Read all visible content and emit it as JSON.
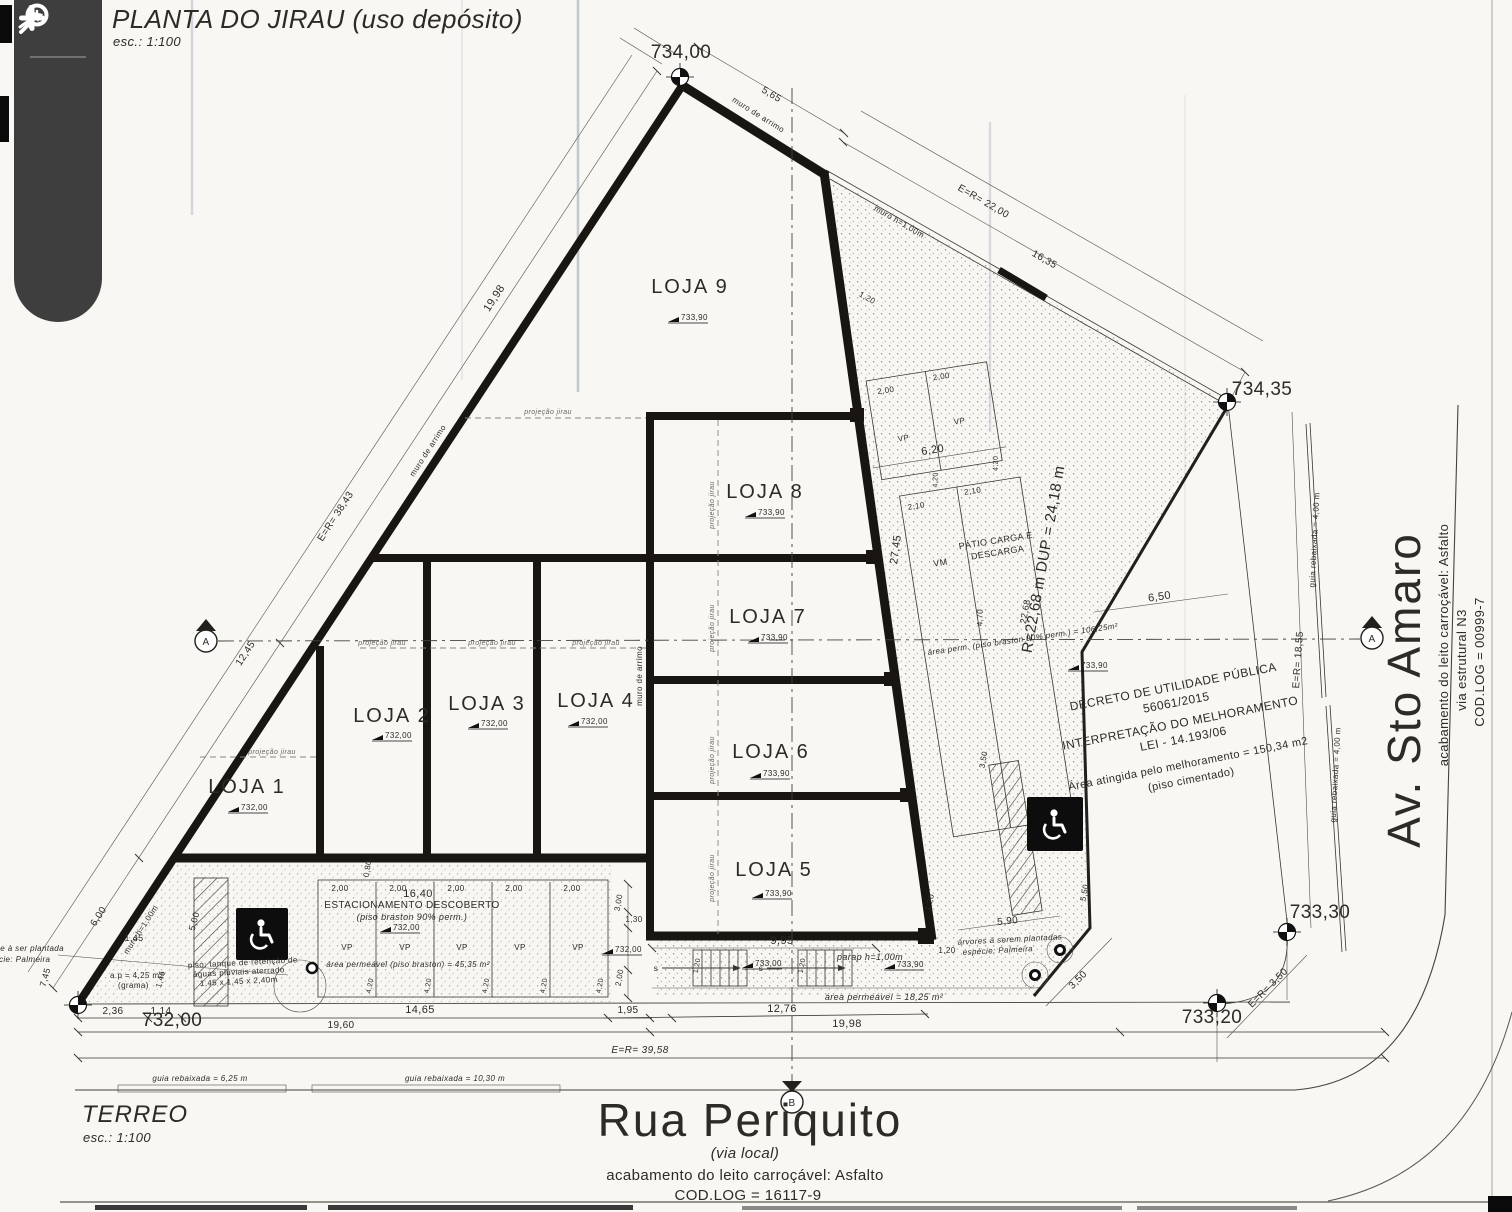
{
  "viewer": {
    "icons": [
      "pan-arrow-icon",
      "zoom-out-icon",
      "magnifier-icon",
      "zoom-in-icon"
    ]
  },
  "title_block": {
    "title": "PLANTA DO JIRAU (uso depósito)",
    "scale": "esc.: 1:100"
  },
  "floor_label": {
    "title": "TERREO",
    "scale": "esc.: 1:100"
  },
  "streets": {
    "rua_periquito": {
      "name": "Rua Periquito",
      "type": "(via local)",
      "surface": "acabamento do leito carroçável: Asfalto",
      "cod_log": "COD.LOG = 16117-9"
    },
    "av_sto_amaro": {
      "name": "Av. Sto Amaro",
      "surface": "acabamento do leito carroçável: Asfalto",
      "type": "via estrutural N3",
      "cod_log": "COD.LOG = 00999-7"
    }
  },
  "decree": {
    "line1": "DECRETO DE UTILIDADE PÚBLICA",
    "line2": "56061/2015",
    "line3": "INTERPRETAÇÃO DO MELHORAMENTO",
    "line4": "LEI - 14.193/06",
    "line5": "Área atingida pelo melhoramento = 150,34 m2",
    "line6": "(piso cimentado)"
  },
  "lojas": [
    {
      "label": "LOJA 1",
      "elev": "732,00"
    },
    {
      "label": "LOJA 2",
      "elev": "732,00"
    },
    {
      "label": "LOJA 3",
      "elev": "732,00"
    },
    {
      "label": "LOJA 4",
      "elev": "732,00"
    },
    {
      "label": "LOJA 5",
      "elev": "733,90"
    },
    {
      "label": "LOJA 6",
      "elev": "733,90"
    },
    {
      "label": "LOJA 7",
      "elev": "733,90"
    },
    {
      "label": "LOJA 8",
      "elev": "733,90"
    },
    {
      "label": "LOJA 9",
      "elev": "733,90"
    }
  ],
  "areas": {
    "parking_title": "ESTACIONAMENTO DESCOBERTO",
    "parking_sub": "(piso braston 90% perm.)",
    "parking_perm": "área permeável (piso braston) = 45,35 m²",
    "patio_line1": "PÁTIO CARGA E",
    "patio_line2": "DESCARGA",
    "patio_perm": "área perm. (piso braston 90% perm.) = 106,25m²",
    "perm_right": "área permeável = 18,25 m²",
    "parapet": "parap h=1,00m",
    "trees_right_1": "árvores à serem plantadas",
    "trees_right_2": "espécie: Palmeira",
    "tree_left_1": "árvore à ser plantada",
    "tree_left_2": "espécie: Palmeira",
    "grass_1": "a.p = 4,25 m2",
    "grass_2": "(grama)",
    "tank_1": "piso: tanque de retenção de",
    "tank_2": "águas pluviais aterrado",
    "tank_3": "1,45 x 1,45 x 2,40m",
    "vp": "VP",
    "vm": "VM",
    "stair_s": "s"
  },
  "levels": {
    "v734_00": "734,00",
    "v734_35": "734,35",
    "v733_30": "733,30",
    "v733_20": "733,20",
    "v732_00": "732,00",
    "v733_90": "733,90",
    "v733_00": "733,00"
  },
  "dims": {
    "d5_65": "5,65",
    "d19_98": "19,98",
    "der38_43": "E=R= 38,43",
    "d12_45": "12,45",
    "d6_00": "6,00",
    "d2_36": "2,36",
    "d1_14": "1,14",
    "d14_65": "14,65",
    "d19_60": "19,60",
    "d1_95": "1,95",
    "d12_76": "12,76",
    "der39_58": "E=R= 39,58",
    "der22_00": "E=R= 22,00",
    "d16_35": "16,35",
    "der18_55": "E=R= 18,55",
    "dup": "R=22,68 m  DUP = 24,18 m",
    "d22_68": "22,68",
    "d27_45": "27,45",
    "d6_20": "6,20",
    "d6_50": "6,50",
    "d4_70": "4,70",
    "d2_00": "2,00",
    "d2_10": "2,10",
    "d4_20": "4,20",
    "d16_40": "16,40",
    "d0_80": "0,80",
    "d3_00": "3,00",
    "d1_30": "1,30",
    "d9_95": "9,95",
    "d1_20": "1,20",
    "d5_90": "5,90",
    "d5_50": "5,50",
    "d3_50": "3,50",
    "der3_50": "E=R= 3,50",
    "d1_45": "1,45",
    "d7_45": "7,45",
    "d5_00": "5,00",
    "guia_6_25": "guia rebaixada = 6,25 m",
    "guia_10_30": "guia rebaixada = 10,30 m",
    "guia_4_00": "guia rebaixada = 4,00 m"
  },
  "notes": {
    "muro_arrimo": "muro de arrimo",
    "muro_h": "muro h=1,00m",
    "projecao": "projeção jirau"
  },
  "sections": {
    "a": "A",
    "b": "B"
  }
}
